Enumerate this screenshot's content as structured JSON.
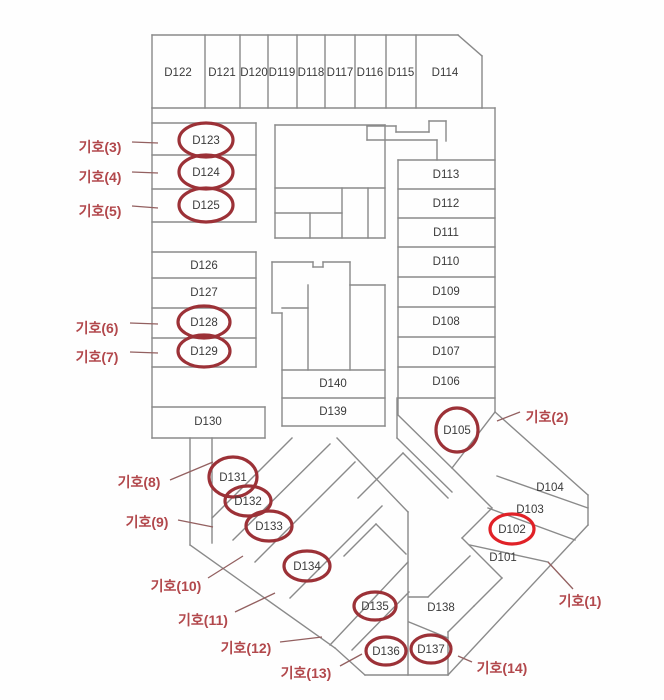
{
  "title": "floor-plan-D-block",
  "canvas": {
    "w": 664,
    "h": 700
  },
  "colors": {
    "wall": "#8a8a8a",
    "room_text": "#3a3a3a",
    "circle": "#9c3137",
    "circle_bright": "#e02127",
    "marker_text": "#b2484c",
    "leader": "#936060",
    "background": "#fefefe"
  },
  "rooms": [
    {
      "label": "D122",
      "x": 178,
      "y": 73,
      "circled": false
    },
    {
      "label": "D121",
      "x": 222,
      "y": 73,
      "circled": false
    },
    {
      "label": "D120",
      "x": 254,
      "y": 73,
      "circled": false
    },
    {
      "label": "D119",
      "x": 282,
      "y": 73,
      "circled": false
    },
    {
      "label": "D118",
      "x": 311,
      "y": 73,
      "circled": false
    },
    {
      "label": "D117",
      "x": 340,
      "y": 73,
      "circled": false
    },
    {
      "label": "D116",
      "x": 370,
      "y": 73,
      "circled": false
    },
    {
      "label": "D115",
      "x": 401,
      "y": 73,
      "circled": false
    },
    {
      "label": "D114",
      "x": 445,
      "y": 73,
      "circled": false
    },
    {
      "label": "D123",
      "x": 206,
      "y": 141,
      "circled": true,
      "rx": 27,
      "ry": 17
    },
    {
      "label": "D124",
      "x": 206,
      "y": 173,
      "circled": true,
      "rx": 27,
      "ry": 17
    },
    {
      "label": "D125",
      "x": 206,
      "y": 206,
      "circled": true,
      "rx": 27,
      "ry": 17
    },
    {
      "label": "D113",
      "x": 446,
      "y": 175,
      "circled": false
    },
    {
      "label": "D112",
      "x": 446,
      "y": 204,
      "circled": false
    },
    {
      "label": "D111",
      "x": 446,
      "y": 233,
      "circled": false
    },
    {
      "label": "D110",
      "x": 446,
      "y": 262,
      "circled": false
    },
    {
      "label": "D109",
      "x": 446,
      "y": 292,
      "circled": false
    },
    {
      "label": "D108",
      "x": 446,
      "y": 322,
      "circled": false
    },
    {
      "label": "D107",
      "x": 446,
      "y": 352,
      "circled": false
    },
    {
      "label": "D106",
      "x": 446,
      "y": 382,
      "circled": false
    },
    {
      "label": "D126",
      "x": 204,
      "y": 266,
      "circled": false
    },
    {
      "label": "D127",
      "x": 204,
      "y": 293,
      "circled": false
    },
    {
      "label": "D128",
      "x": 204,
      "y": 323,
      "circled": true,
      "rx": 26,
      "ry": 16
    },
    {
      "label": "D129",
      "x": 204,
      "y": 352,
      "circled": true,
      "rx": 26,
      "ry": 16
    },
    {
      "label": "D140",
      "x": 333,
      "y": 384,
      "circled": false
    },
    {
      "label": "D139",
      "x": 333,
      "y": 412,
      "circled": false
    },
    {
      "label": "D130",
      "x": 208,
      "y": 422,
      "circled": false
    },
    {
      "label": "D105",
      "x": 457,
      "y": 431,
      "circled": true,
      "rx": 21,
      "ry": 22
    },
    {
      "label": "D131",
      "x": 233,
      "y": 478,
      "circled": true,
      "rx": 24,
      "ry": 20
    },
    {
      "label": "D132",
      "x": 248,
      "y": 502,
      "circled": true,
      "rx": 23,
      "ry": 15
    },
    {
      "label": "D133",
      "x": 269,
      "y": 527,
      "circled": true,
      "rx": 23,
      "ry": 15
    },
    {
      "label": "D134",
      "x": 307,
      "y": 567,
      "circled": true,
      "rx": 23,
      "ry": 15
    },
    {
      "label": "D135",
      "x": 375,
      "y": 607,
      "circled": true,
      "rx": 21,
      "ry": 14
    },
    {
      "label": "D136",
      "x": 386,
      "y": 652,
      "circled": true,
      "rx": 20,
      "ry": 14
    },
    {
      "label": "D137",
      "x": 431,
      "y": 650,
      "circled": true,
      "rx": 20,
      "ry": 14
    },
    {
      "label": "D138",
      "x": 441,
      "y": 608,
      "circled": false
    },
    {
      "label": "D104",
      "x": 550,
      "y": 488,
      "circled": false
    },
    {
      "label": "D103",
      "x": 530,
      "y": 510,
      "circled": false
    },
    {
      "label": "D102",
      "x": 512,
      "y": 530,
      "circled": true,
      "bright": true,
      "rx": 22,
      "ry": 15
    },
    {
      "label": "D101",
      "x": 503,
      "y": 558,
      "circled": false
    }
  ],
  "markers": [
    {
      "label": "기호(1)",
      "x": 580,
      "y": 601,
      "lx1": 548,
      "ly1": 562,
      "lx2": 573,
      "ly2": 589
    },
    {
      "label": "기호(2)",
      "x": 547,
      "y": 417,
      "lx1": 497,
      "ly1": 421,
      "lx2": 520,
      "ly2": 412
    },
    {
      "label": "기호(3)",
      "x": 100,
      "y": 147,
      "lx1": 132,
      "ly1": 142,
      "lx2": 158,
      "ly2": 143
    },
    {
      "label": "기호(4)",
      "x": 100,
      "y": 177,
      "lx1": 132,
      "ly1": 172,
      "lx2": 158,
      "ly2": 173
    },
    {
      "label": "기호(5)",
      "x": 100,
      "y": 211,
      "lx1": 132,
      "ly1": 206,
      "lx2": 158,
      "ly2": 208
    },
    {
      "label": "기호(6)",
      "x": 97,
      "y": 328,
      "lx1": 130,
      "ly1": 323,
      "lx2": 158,
      "ly2": 324
    },
    {
      "label": "기호(7)",
      "x": 97,
      "y": 357,
      "lx1": 130,
      "ly1": 352,
      "lx2": 158,
      "ly2": 353
    },
    {
      "label": "기호(8)",
      "x": 139,
      "y": 482,
      "lx1": 170,
      "ly1": 480,
      "lx2": 213,
      "ly2": 462
    },
    {
      "label": "기호(9)",
      "x": 147,
      "y": 522,
      "lx1": 178,
      "ly1": 520,
      "lx2": 213,
      "ly2": 527
    },
    {
      "label": "기호(10)",
      "x": 176,
      "y": 586,
      "lx1": 208,
      "ly1": 578,
      "lx2": 243,
      "ly2": 556
    },
    {
      "label": "기호(11)",
      "x": 203,
      "y": 620,
      "lx1": 235,
      "ly1": 612,
      "lx2": 275,
      "ly2": 593
    },
    {
      "label": "기호(12)",
      "x": 246,
      "y": 648,
      "lx1": 280,
      "ly1": 642,
      "lx2": 322,
      "ly2": 637
    },
    {
      "label": "기호(13)",
      "x": 306,
      "y": 673,
      "lx1": 340,
      "ly1": 666,
      "lx2": 362,
      "ly2": 654
    },
    {
      "label": "기호(14)",
      "x": 502,
      "y": 668,
      "lx1": 458,
      "ly1": 656,
      "lx2": 472,
      "ly2": 662
    }
  ],
  "walls": [
    [
      152,
      35,
      458,
      35
    ],
    [
      458,
      35,
      482,
      56
    ],
    [
      482,
      56,
      482,
      108
    ],
    [
      482,
      108,
      152,
      108
    ],
    [
      152,
      35,
      152,
      108
    ],
    [
      205,
      35,
      205,
      108
    ],
    [
      240,
      35,
      240,
      108
    ],
    [
      268,
      35,
      268,
      108
    ],
    [
      297,
      35,
      297,
      108
    ],
    [
      325,
      35,
      325,
      108
    ],
    [
      355,
      35,
      355,
      108
    ],
    [
      386,
      35,
      386,
      108
    ],
    [
      416,
      35,
      416,
      108
    ],
    [
      152,
      108,
      152,
      438
    ],
    [
      152,
      123,
      256,
      123
    ],
    [
      256,
      123,
      256,
      222
    ],
    [
      152,
      155,
      256,
      155
    ],
    [
      152,
      189,
      256,
      189
    ],
    [
      152,
      222,
      256,
      222
    ],
    [
      152,
      252,
      256,
      252
    ],
    [
      256,
      252,
      256,
      367
    ],
    [
      152,
      278,
      256,
      278
    ],
    [
      152,
      308,
      256,
      308
    ],
    [
      152,
      338,
      256,
      338
    ],
    [
      152,
      367,
      256,
      367
    ],
    [
      152,
      407,
      265,
      407
    ],
    [
      265,
      407,
      265,
      438
    ],
    [
      152,
      438,
      265,
      438
    ],
    [
      275,
      125,
      385,
      125
    ],
    [
      385,
      125,
      385,
      238
    ],
    [
      275,
      238,
      385,
      238
    ],
    [
      275,
      125,
      275,
      238
    ],
    [
      275,
      188,
      385,
      188
    ],
    [
      275,
      213,
      342,
      213
    ],
    [
      342,
      188,
      342,
      238
    ],
    [
      368,
      188,
      368,
      238
    ],
    [
      310,
      213,
      310,
      238
    ],
    [
      367,
      126,
      367,
      140
    ],
    [
      367,
      126,
      396,
      126
    ],
    [
      396,
      126,
      396,
      132
    ],
    [
      396,
      132,
      429,
      132
    ],
    [
      429,
      132,
      429,
      121
    ],
    [
      429,
      121,
      446,
      121
    ],
    [
      446,
      121,
      446,
      141
    ],
    [
      367,
      140,
      437,
      140
    ],
    [
      437,
      140,
      437,
      160
    ],
    [
      482,
      108,
      495,
      108
    ],
    [
      495,
      108,
      495,
      412
    ],
    [
      398,
      160,
      398,
      398
    ],
    [
      398,
      160,
      495,
      160
    ],
    [
      398,
      189,
      495,
      189
    ],
    [
      398,
      218,
      495,
      218
    ],
    [
      398,
      247,
      495,
      247
    ],
    [
      398,
      277,
      495,
      277
    ],
    [
      398,
      307,
      495,
      307
    ],
    [
      398,
      337,
      495,
      337
    ],
    [
      398,
      367,
      495,
      367
    ],
    [
      398,
      398,
      495,
      398
    ],
    [
      398,
      398,
      398,
      415
    ],
    [
      398,
      415,
      452,
      468
    ],
    [
      452,
      468,
      495,
      412
    ],
    [
      272,
      262,
      313,
      262
    ],
    [
      313,
      262,
      313,
      267
    ],
    [
      313,
      267,
      323,
      267
    ],
    [
      323,
      262,
      323,
      267
    ],
    [
      323,
      262,
      350,
      262
    ],
    [
      350,
      262,
      350,
      285
    ],
    [
      350,
      285,
      385,
      285
    ],
    [
      385,
      285,
      385,
      426
    ],
    [
      282,
      426,
      385,
      426
    ],
    [
      282,
      313,
      282,
      426
    ],
    [
      272,
      262,
      272,
      313
    ],
    [
      272,
      313,
      282,
      313
    ],
    [
      282,
      370,
      385,
      370
    ],
    [
      282,
      398,
      385,
      398
    ],
    [
      308,
      285,
      308,
      370
    ],
    [
      350,
      285,
      350,
      370
    ],
    [
      282,
      308,
      308,
      308
    ],
    [
      397,
      398,
      397,
      438
    ],
    [
      397,
      438,
      452,
      492
    ],
    [
      190,
      438,
      190,
      545
    ],
    [
      190,
      545,
      335,
      648
    ],
    [
      335,
      648,
      365,
      675
    ],
    [
      365,
      675,
      448,
      675
    ],
    [
      337,
      438,
      408,
      512
    ],
    [
      408,
      512,
      408,
      675
    ],
    [
      212,
      438,
      212,
      543
    ],
    [
      212,
      518,
      292,
      438
    ],
    [
      233,
      540,
      330,
      444
    ],
    [
      255,
      562,
      355,
      462
    ],
    [
      290,
      598,
      382,
      506
    ],
    [
      330,
      645,
      408,
      562
    ],
    [
      352,
      650,
      409,
      592
    ],
    [
      403,
      453,
      358,
      498
    ],
    [
      403,
      453,
      448,
      498
    ],
    [
      376,
      524,
      344,
      556
    ],
    [
      376,
      524,
      406,
      554
    ],
    [
      409,
      597,
      428,
      597
    ],
    [
      428,
      597,
      470,
      556
    ],
    [
      409,
      622,
      448,
      638
    ],
    [
      452,
      468,
      492,
      508
    ],
    [
      492,
      508,
      462,
      538
    ],
    [
      462,
      538,
      502,
      578
    ],
    [
      502,
      578,
      474,
      606
    ],
    [
      474,
      606,
      448,
      632
    ],
    [
      448,
      632,
      448,
      675
    ],
    [
      497,
      476,
      588,
      508
    ],
    [
      488,
      508,
      575,
      540
    ],
    [
      470,
      545,
      548,
      562
    ],
    [
      495,
      412,
      588,
      495
    ],
    [
      588,
      495,
      588,
      525
    ],
    [
      588,
      525,
      448,
      675
    ]
  ]
}
